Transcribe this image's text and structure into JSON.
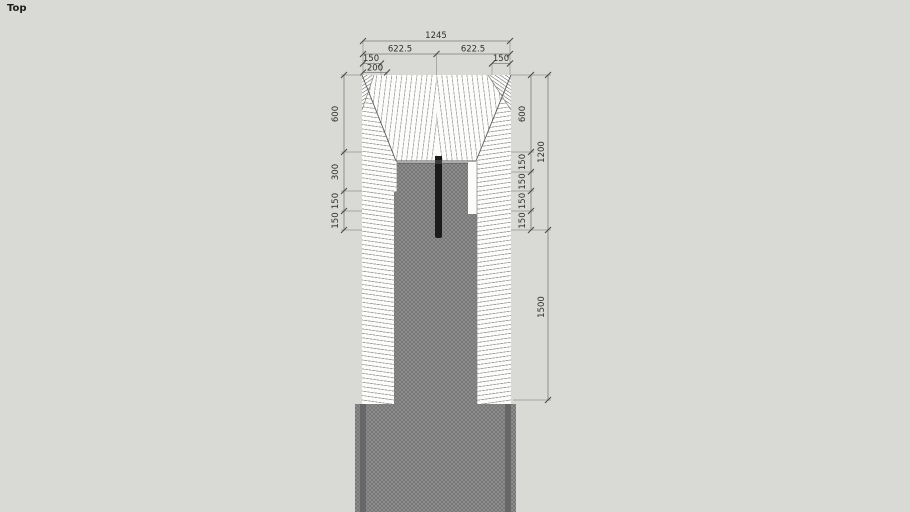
{
  "viewport": {
    "label": "Top"
  },
  "colors": {
    "background": "#d9d9d5",
    "paper": "#fcfcfa",
    "pile_fill": "#838383",
    "casing_band": "#5f5f5f",
    "instrument_bar": "#1a1a1a",
    "dim_text": "#2f2f2f"
  },
  "dims": {
    "total_width": "1245",
    "half_left": "622.5",
    "half_right": "622.5",
    "edge_left_a": "150",
    "edge_left_b": "200",
    "edge_right": "150",
    "left_chain": [
      "600",
      "300",
      "150",
      "150"
    ],
    "right_chain": [
      "600",
      "150",
      "150",
      "150",
      "150"
    ],
    "overall_upper": "1200",
    "overall_lower": "1500"
  }
}
